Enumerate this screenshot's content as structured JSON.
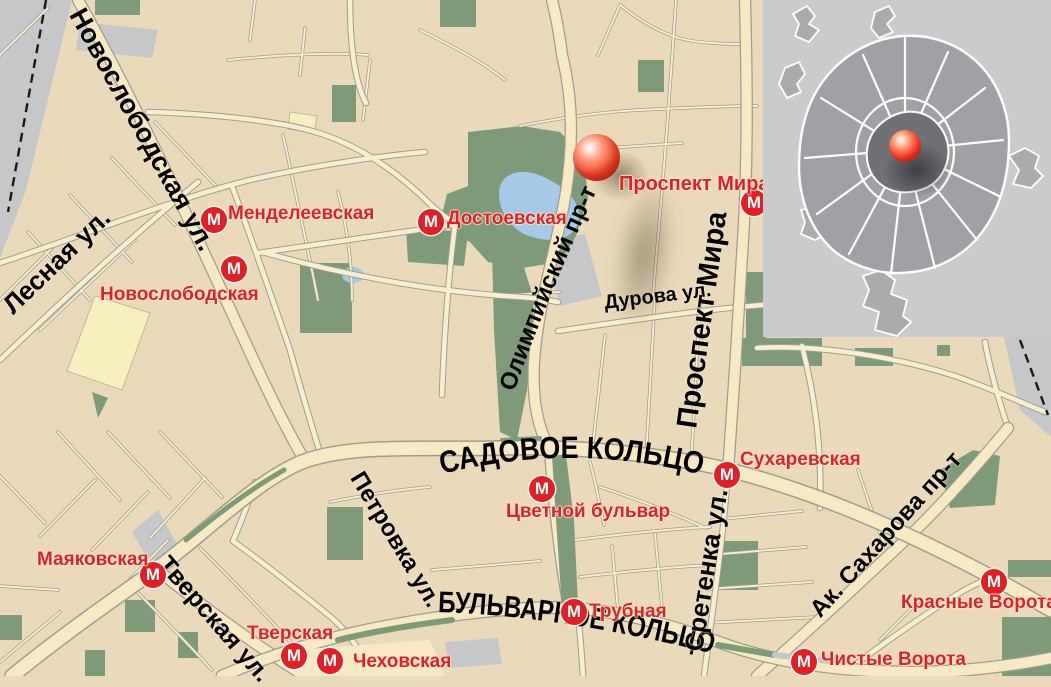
{
  "metro": {
    "symbol": "М"
  },
  "colors": {
    "land": "#EBDABA",
    "road_fill": "#F8EFD0",
    "major_road_fill": "#F7EAC2",
    "road_casing": "#9E9D92",
    "green_area": "#7E9A78",
    "water": "#A5C9E8",
    "gray_area": "#C6C7C9",
    "metro_red": "#E31E24",
    "street_label": "#000000",
    "marker_red": "#E8402A",
    "inset_bg": "#C9CBCD",
    "inset_city": "#9FA1A4",
    "inset_center": "#6F7174"
  },
  "streets": {
    "novoslobodskaya": "Новослободская ул.",
    "lesnaya": "Лесная ул.",
    "olimpiysky": "Олимпийский пр-т",
    "durova": "Дурова ул.",
    "prospekt_mira": "Проспект Мира",
    "sadovoe_ring": "САДОВОЕ КОЛЬЦО",
    "petrovka": "Петровка ул.",
    "tverskaya": "Тверская ул.",
    "bulvar_ring": "БУЛЬВАРНОЕ КОЛЬЦО",
    "sretenka": "Сретенка ул.",
    "sakharova": "Ак. Сахарова пр-т"
  },
  "stations": {
    "mendeleevskaya": "Менделеевская",
    "novoslobodskaya": "Новослободская",
    "dostoevskaya": "Достоевская",
    "prospekt_mira": "Проспект Мира",
    "sukharevskaya": "Сухаревская",
    "tsvetnoy_bulvar": "Цветной бульвар",
    "mayakovskaya": "Маяковская",
    "tverskaya": "Тверская",
    "chekhovskaya": "Чеховская",
    "trubnaya": "Трубная",
    "krasnye_vorota": "Красные Ворота",
    "chistye_vorota": "Чистые Ворота"
  }
}
